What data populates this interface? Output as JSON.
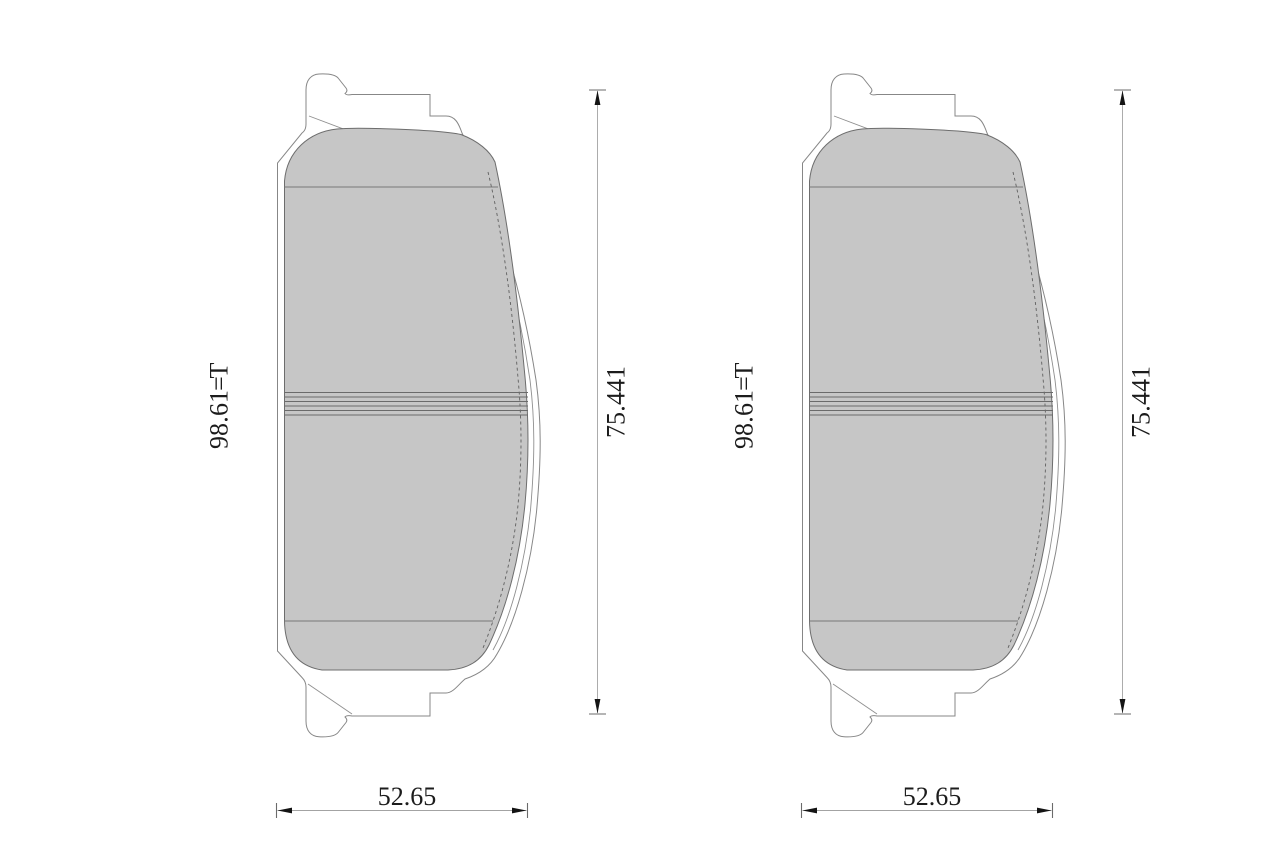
{
  "document": {
    "type": "technical dimension drawing",
    "subject": "disc brake pad set, two pad front views with dimensions",
    "background": "#ffffff"
  },
  "colors": {
    "pad_fill": "#c6c6c6",
    "backplate_outline": "#878787",
    "dimension_line": "#a3a3a3",
    "arrow": "#141414",
    "text": "#1c1c1c"
  },
  "views": [
    {
      "id": "left-pad",
      "thickness_label": "T=16.89",
      "height_label": "144.57",
      "width_label": "52.65"
    },
    {
      "id": "right-pad",
      "thickness_label": "T=16.89",
      "height_label": "144.57",
      "width_label": "52.65"
    }
  ]
}
